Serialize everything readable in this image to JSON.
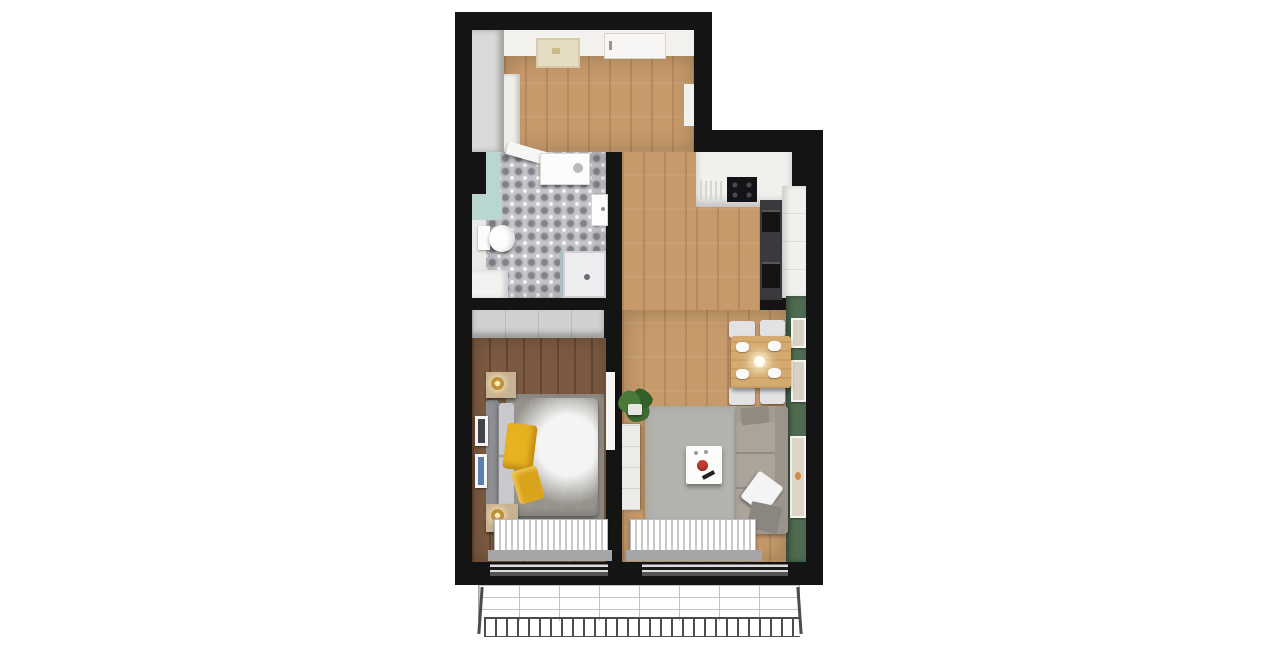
{
  "scene": {
    "type": "apartment-floor-plan-3d-top-view",
    "background": "#ffffff",
    "rooms": [
      {
        "id": "entry-hall",
        "floor": "light-wood",
        "items": [
          "wardrobe",
          "wall-cabinet",
          "entrance-door",
          "ceiling-lamp",
          "mirror-panel"
        ]
      },
      {
        "id": "bathroom",
        "floor": "patterned-gray-tile",
        "accent_wall": "teal",
        "items": [
          "toilet",
          "washing-machine",
          "open-door-leaf",
          "wall-sink",
          "shower",
          "cabinet"
        ]
      },
      {
        "id": "kitchen",
        "floor": "light-wood",
        "items": [
          "l-counter",
          "cooktop",
          "dish-rack",
          "dark-tall-cabinet",
          "built-in-ovens",
          "white-tall-cabinet"
        ]
      },
      {
        "id": "living-room",
        "floor": "light-wood",
        "accent_wall": "green",
        "items": [
          "dining-table",
          "dining-chairs",
          "plates",
          "pendant-lamp",
          "rug",
          "coffee-table",
          "sofa",
          "pillow",
          "throw-blanket",
          "console",
          "potted-plant",
          "radiator",
          "window",
          "wall-frames"
        ]
      },
      {
        "id": "bedroom",
        "floor": "dark-wood",
        "items": [
          "wardrobe",
          "double-bed",
          "headboard",
          "pillows",
          "yellow-blanket",
          "nightstands",
          "brass-lamps",
          "rug",
          "wall-frames",
          "radiator",
          "window",
          "door-leaf"
        ]
      },
      {
        "id": "balcony",
        "style": "unrendered-wireframe",
        "items": [
          "tile-grid-floor",
          "bar-railing",
          "corner-posts"
        ]
      }
    ],
    "counts": {
      "dining_chairs": 4,
      "dining_plates": 4,
      "green_wall_frames": 3,
      "bedroom_wall_frames": 2,
      "nightstands": 2,
      "radiators": 2,
      "south_windows": 2
    }
  },
  "colors": {
    "wall": "#141414",
    "wall_face": "#f3f1ee",
    "wood": "#c69a6b",
    "wood_dark": "#7c5a41",
    "tile_base": "#c4c4c9",
    "tile_dot": "#82828a",
    "teal": "#b9d6d1",
    "green_wall": "#4e6b50",
    "rug_living": "#b4b2ad",
    "rug_bedroom": "#96938c",
    "sofa": "#aba49b",
    "sofa_dark": "#9a948b",
    "chair": "#e2e2e4",
    "table_wood": "#d4aa6e",
    "duvet": "#f4f4f6",
    "yellow": "#e7b120",
    "radiator_stripe": "#c8c8cb",
    "wardrobe_hall": "#d9d9d7",
    "wardrobe_bedroom": "#d0d0ce",
    "counter": "#f2f0ed",
    "cabinet_dark": "#3a3a3e",
    "appliance_black": "#141416",
    "balcony_line": "#b9b9b9",
    "railing": "#4c4c4c",
    "nightstand": "#c7b294",
    "brass": "#ba9240",
    "plant_green": "#3f6b33",
    "accent_red": "#c23b2e",
    "door_white": "#f7f6f4",
    "mat_beige": "#e6dcc4",
    "sill": "#a6a6a8",
    "headboard": "#8f8f93",
    "pillow_gray": "#c9c9cd",
    "shower_tray": "#ededef",
    "console_white": "#edebe8",
    "frame_white": "#f5f5f3",
    "art_blue": "#5b7fb0"
  }
}
